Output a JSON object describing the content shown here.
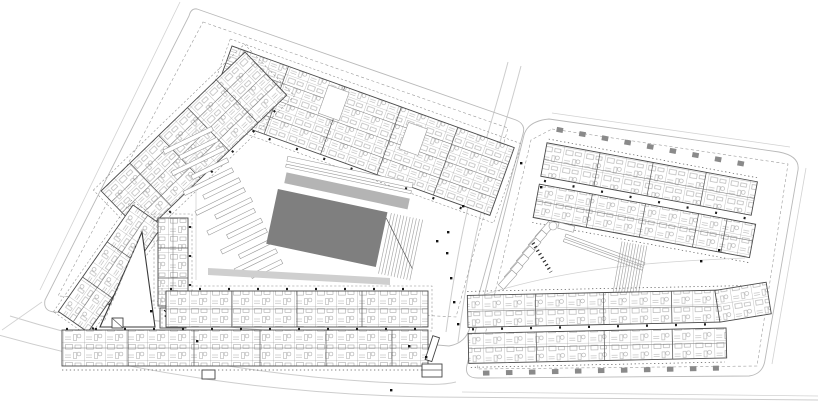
{
  "canvas": {
    "width": 818,
    "height": 403,
    "background": "#ffffff"
  },
  "palette": {
    "background": "#ffffff",
    "hall_roof_gray": "#7f7f7f",
    "canopy_gray": "#b4b4b4",
    "sidewalk_gray": "#cfcfcf",
    "road_line": "#cdcdcd",
    "parcel_line": "#b9b9b9",
    "building_line": "#4a4a4a",
    "detail_line": "#8a8a8a",
    "marker_black": "#141414"
  },
  "components": {
    "site-plan-canvas": "architectural master plan drawing, ground-floor scale, no text labels",
    "parcel-west": "west urban block: chevron housing bars, market hall with gray roof, parking strips, triangular courtyard, south housing rows",
    "parcel-east": "east urban block: two north slabs with roof balconies, courtyard with ramps and parking, double south slab with balconies",
    "market-hall-roof": "large dark gray rotated roof slab",
    "canopy-strip": "light gray elongated canopy over hall entry",
    "parking-strips-west": "stack of thin angled parking / planting strips",
    "entrance-markers": "small black entry arrows scattered along facades and streets"
  }
}
